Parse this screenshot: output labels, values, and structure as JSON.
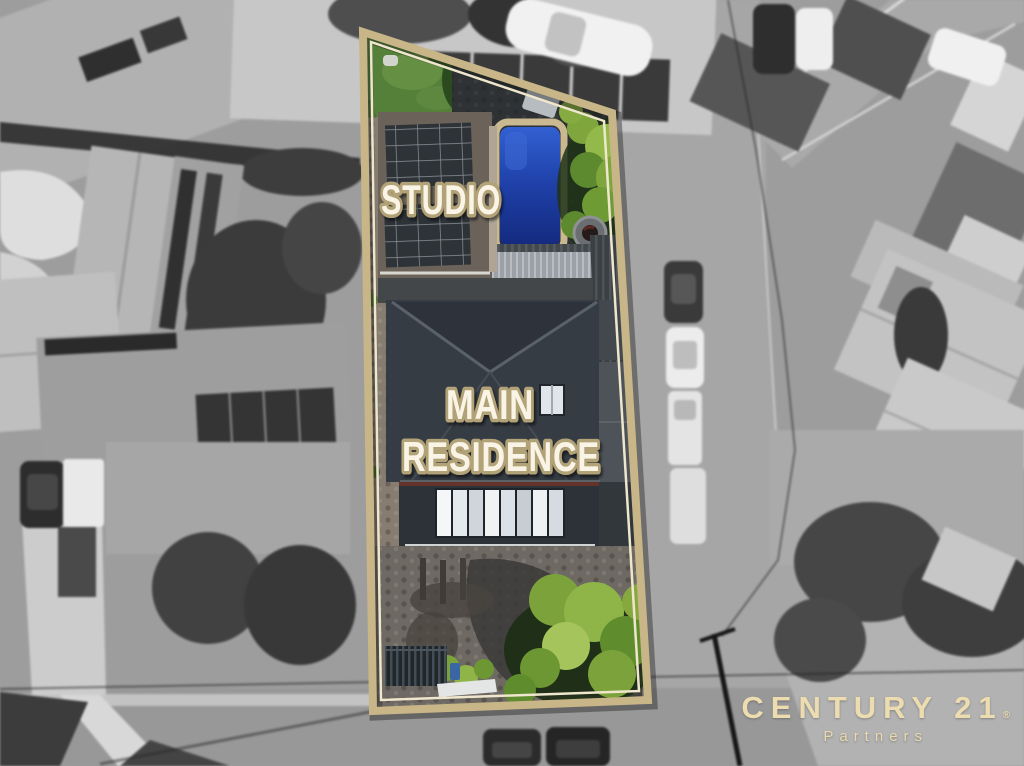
{
  "scene": {
    "description": "Top-down aerial drone photograph of a residential block for sale: the property is shown in colour and outlined in tan, while the surrounding neighbourhood, streets, parked cars and rooftops are desaturated grayscale."
  },
  "property": {
    "labels": {
      "studio": "STUDIO",
      "main_line1": "MAIN",
      "main_line2": "RESIDENCE"
    },
    "features": [
      "studio with rooftop solar panels",
      "swimming pool",
      "palm trees",
      "main residence roof with skylight",
      "cobbled driveway",
      "garden"
    ]
  },
  "branding": {
    "brand": "CENTURY 21",
    "registered_mark": "®",
    "subtitle": "Partners"
  },
  "colors": {
    "boundary_tan": "#c8b689",
    "boundary_inner_line": "#efe7cd",
    "label_fill": "#f9f4e6",
    "label_outline": "#b2a277",
    "pool_blue": "#1e3fa6",
    "logo_cream": "#ecdcb0"
  }
}
